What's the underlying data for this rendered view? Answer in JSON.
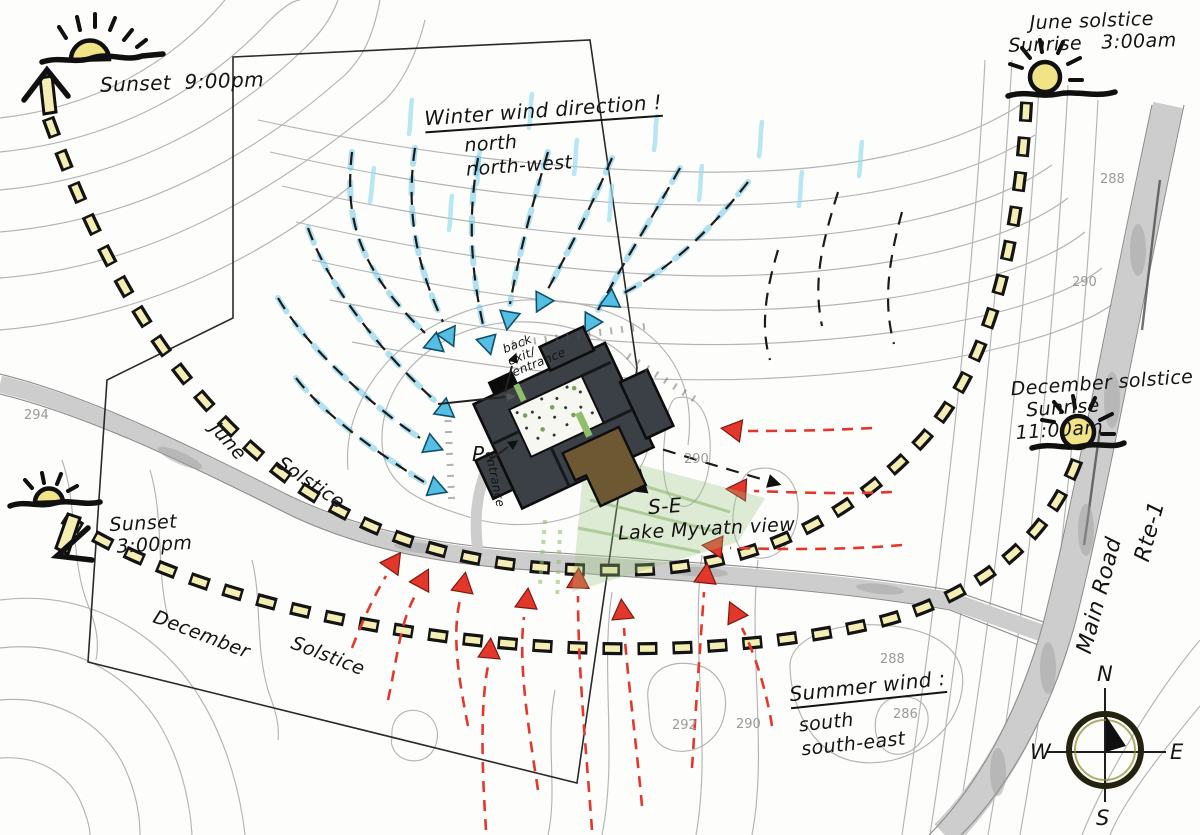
{
  "colors": {
    "contour": "#b4b4b4",
    "road_fill": "#cdcdcd",
    "winter_wind": "#55bfe3",
    "summer_wind": "#e2382b",
    "sun_fill": "#f0e486",
    "dash_fill": "#f5eeb4",
    "building": "#3b4046",
    "building_wing": "#6e5733",
    "view_green": "#9dc57f"
  },
  "sun_events": {
    "june_sunset": {
      "label": "Sunset",
      "time": "9:00pm"
    },
    "june_sunrise": {
      "title": "June solstice",
      "label": "Sunrise",
      "time": "3:00am"
    },
    "december_sunrise": {
      "title": "December solstice",
      "label": "Sunrise",
      "time": "11:00am"
    },
    "december_sunset": {
      "label": "Sunset",
      "time": "3:00pm"
    }
  },
  "wind": {
    "winter": {
      "title": "Winter wind direction !",
      "directions": [
        "north",
        "north-west"
      ]
    },
    "summer": {
      "title": "Summer wind :",
      "directions": [
        "south",
        "south-east"
      ]
    }
  },
  "sun_paths": {
    "june": {
      "word1": "June",
      "word2": "Solstice"
    },
    "december": {
      "word1": "December",
      "word2": "Solstice"
    }
  },
  "site": {
    "view_direction": "S-E",
    "view_label": "Lake Myvatn view",
    "parking": "P",
    "entrance": "entrance",
    "back_entrance": [
      "back",
      "exit/",
      "entrance"
    ]
  },
  "road": {
    "name": "Main Road",
    "route": "Rte-1"
  },
  "compass": {
    "north": "N",
    "east": "E",
    "south": "S",
    "west": "W"
  },
  "contour_labels": [
    "294",
    "288",
    "290",
    "290",
    "288",
    "286",
    "292",
    "290"
  ]
}
